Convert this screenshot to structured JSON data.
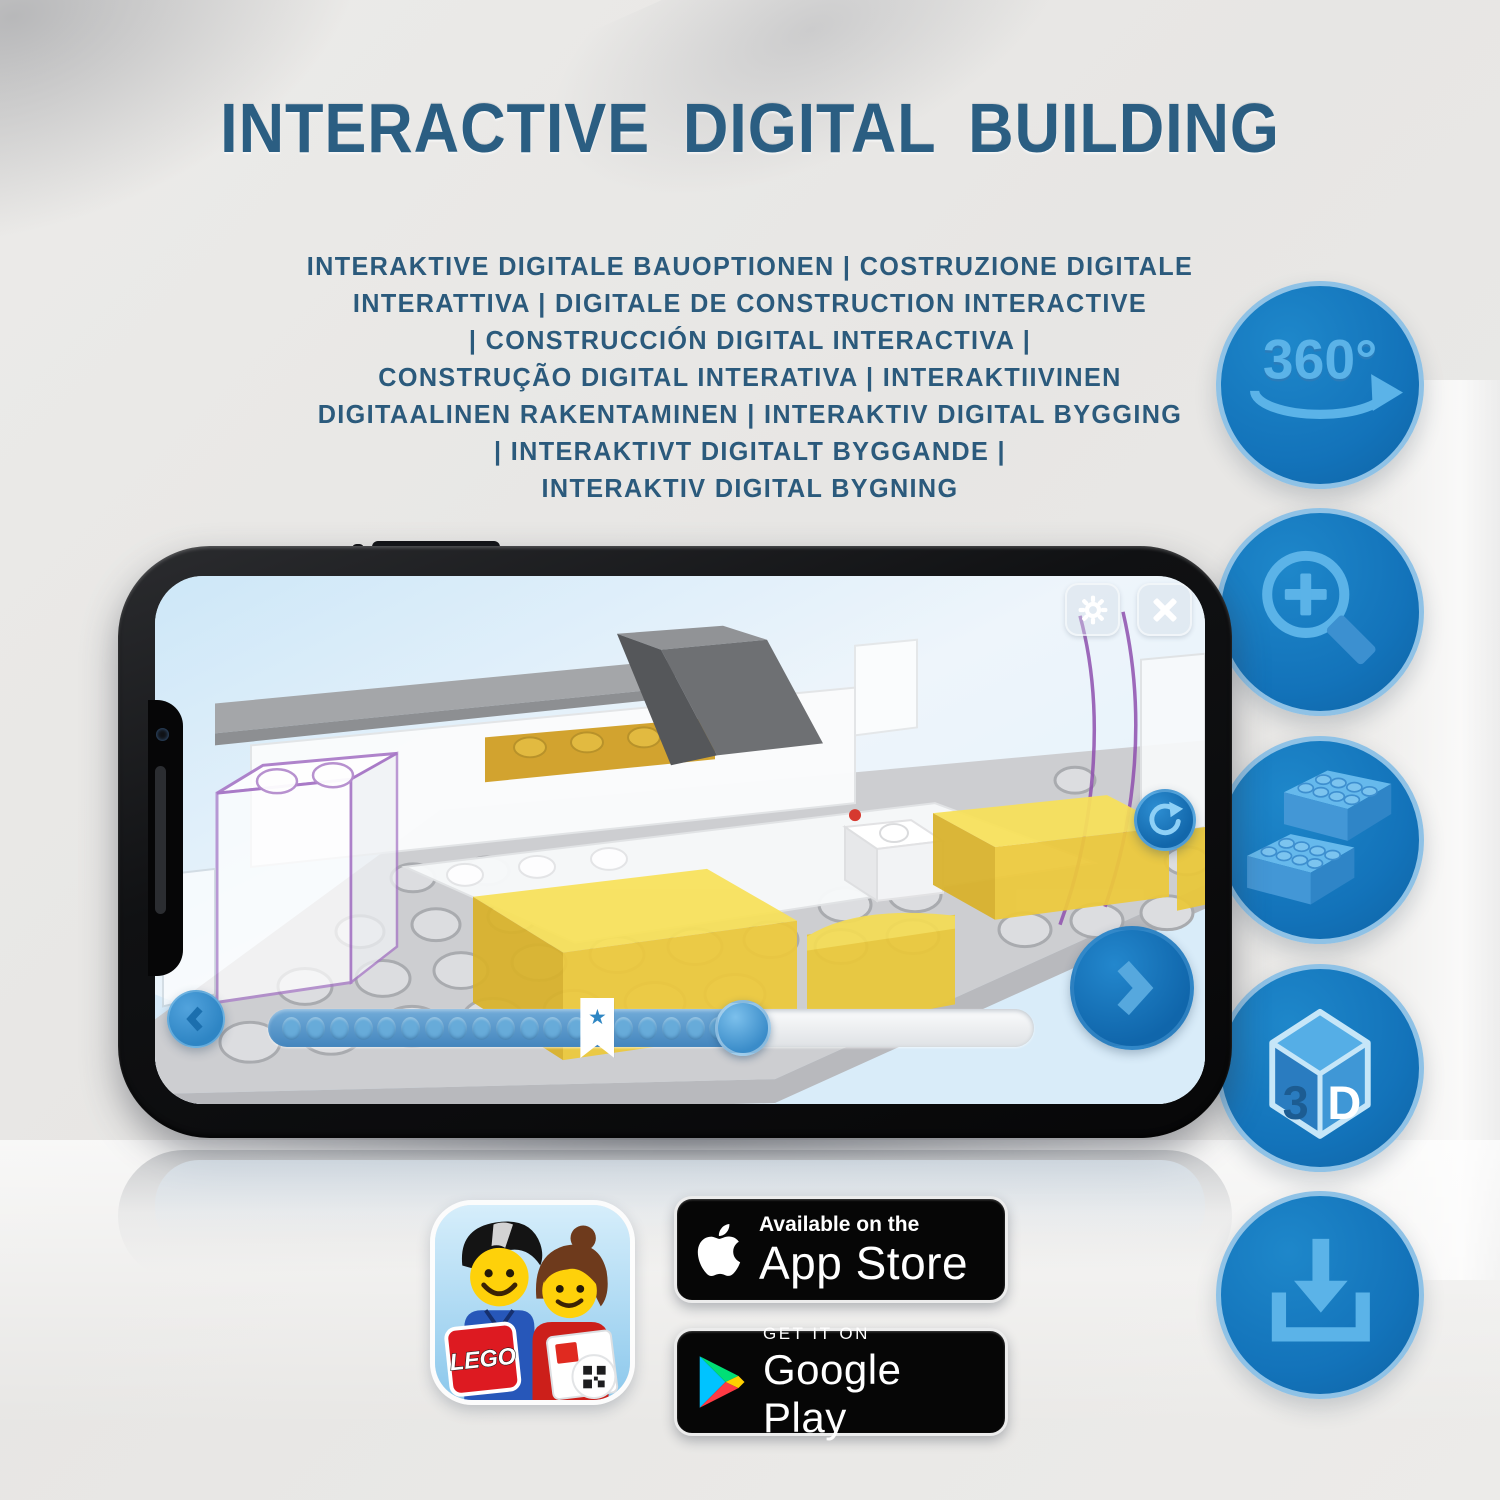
{
  "header": {
    "title": "INTERACTIVE DIGITAL BUILDING",
    "subtitle_lines": [
      "INTERAKTIVE DIGITALE BAUOPTIONEN | COSTRUZIONE DIGITALE",
      "INTERATTIVA | DIGITALE DE CONSTRUCTION INTERACTIVE",
      "| CONSTRUCCIÓN DIGITAL INTERACTIVA |",
      "CONSTRUÇÃO DIGITAL INTERATIVA | INTERAKTIIVINEN",
      "DIGITAALINEN RAKENTAMINEN | INTERAKTIV DIGITAL BYGGING",
      "| INTERAKTIVT DIGITALT BYGGANDE |",
      "INTERAKTIV DIGITAL BYGNING"
    ]
  },
  "features": {
    "icon_names": [
      "360-rotation-icon",
      "zoom-in-icon",
      "brick-icon",
      "3d-cube-icon",
      "download-icon"
    ],
    "rotation_label": "360°",
    "cube_face_left": "3",
    "cube_face_right": "D"
  },
  "phone": {
    "slider": {
      "dot_count": 19,
      "progress_percent": 62,
      "star_percent": 43
    }
  },
  "icons": {
    "star": "★"
  },
  "store": {
    "app_icon_logo": "LEGO",
    "app_store_badge": {
      "line1": "Available on the",
      "line2": "App Store"
    },
    "google_play_badge": {
      "line1": "GET IT ON",
      "line2": "Google Play"
    }
  },
  "colors": {
    "title_blue": "#2b5e82",
    "subtitle_blue": "#2b5a7c",
    "circle_blue": "#1373ba",
    "circle_ring": "#8fc2e6",
    "icon_blue": "#5bb3e8",
    "ui_blue": "#2f88c8",
    "brick_yellow": "#f2d53e"
  }
}
